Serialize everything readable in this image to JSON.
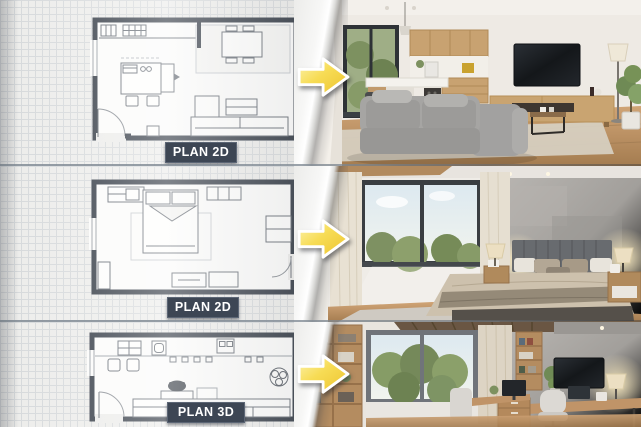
{
  "rows": [
    {
      "room": "living-room",
      "plan_label": "PLAN 2D"
    },
    {
      "room": "bedroom",
      "plan_label": "PLAN 2D"
    },
    {
      "room": "home-office",
      "plan_label": "PLAN 3D"
    }
  ],
  "icons": {
    "transform": "arrow-right-icon"
  },
  "colors": {
    "badge-bg": "#3d4654",
    "badge-border": "#5c6675",
    "badge-text": "#ffffff",
    "arrow-light": "#fcf4b2",
    "arrow-mid": "#f7dc55",
    "arrow-dark": "#ecc32e",
    "arrow-border": "#ffffff",
    "paper": "#ededeb",
    "grid-line": "#d7dadc",
    "plan-wall": "#3a414b",
    "plan-line": "#6a7078",
    "divider": "#8c96a0",
    "wood-floor": "#c2986a",
    "cabinet-wood": "#c8a271",
    "wall-white": "#eeeae4",
    "concrete-wall": "#a09d99",
    "sofa-grey": "#a4a3a1",
    "tv-black": "#1b1e22",
    "foliage-green": "#7d9160",
    "curtain-beige": "#e8e1d3"
  }
}
